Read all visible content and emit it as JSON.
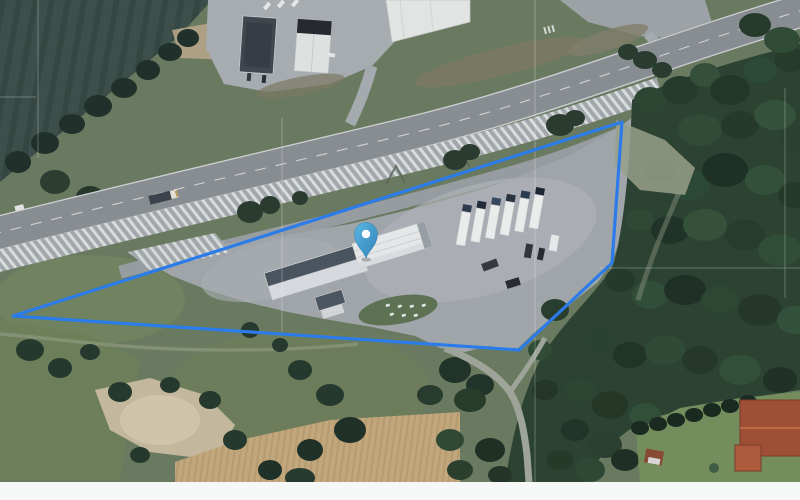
{
  "map": {
    "view_type": "satellite-imagery",
    "overlay": {
      "parcel_polygon": {
        "points": "13,316 622,122 612,263 519,350",
        "stroke_color": "#2b7ce9",
        "stroke_width": 3.2,
        "fill": "none"
      },
      "pin": {
        "transform": "translate(366,258)",
        "fill_top": "#5cb7e4",
        "fill_bottom": "#2e82b6",
        "outline": "#2b7fae",
        "dot_color": "#ffffff"
      }
    },
    "features": [
      "highway-with-lane-markings",
      "hatched-road-shoulder",
      "rest-area-parking-lot",
      "warehouse-building-white-roof",
      "truck-trailer-row",
      "roadside-facility-buildings",
      "dark-crop-field",
      "forest",
      "sand-pit",
      "plowed-field",
      "red-roof-house",
      "cadastral-boundary-lines"
    ]
  },
  "palette": {
    "page_background": "#f6f7f7",
    "base_grass": "#6b7c5f",
    "dark_field": "#3b4f48",
    "forest_green": "#2a4130",
    "asphalt_lot": "#a4a9ad",
    "highway_gray": "#8b9094",
    "hatch_white": "#e6e9e9",
    "building_white": "#eceeee",
    "building_dark_roof": "#49545e",
    "truck_white": "#f2f3f2",
    "sand": "#c9bda0",
    "plowed_field": "#c8ab7e",
    "house_roof_red": "#a34f33",
    "overlay_blue": "#2b7ce9",
    "pin_blue": "#3f9fd4"
  }
}
